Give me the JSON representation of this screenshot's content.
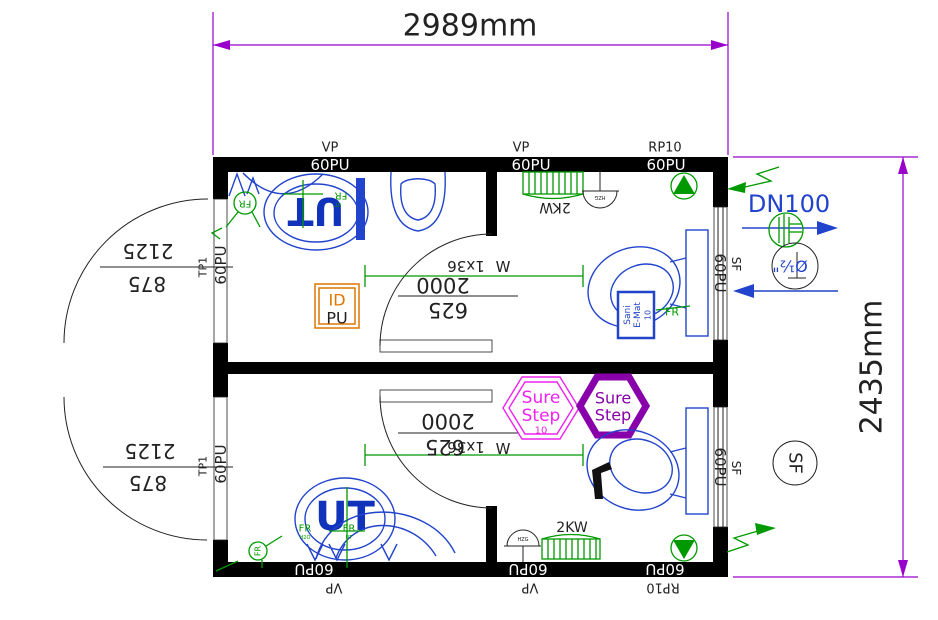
{
  "colors": {
    "wall": "#000000",
    "dimension": "#9900cc",
    "fixture_blue": "#2244cc",
    "logo_blue": "#1133bb",
    "annotation_green": "#009900",
    "hex_magenta": "#ee22ee",
    "hex_purple": "#8800aa",
    "id_orange": "#dd7700",
    "ink": "#222222"
  },
  "dimensions": {
    "overall_width": "2989mm",
    "overall_height": "2435mm",
    "door_height": "2125",
    "door_width": "875",
    "room_length": "2000",
    "room_offset": "625"
  },
  "walls": {
    "vp": "VP",
    "rp10": "RP10",
    "panel": "60PU",
    "door_panel": "TP1",
    "sf": "SF"
  },
  "annotations": {
    "dn100": "DN100",
    "pipe_diameter": "Ø½\"",
    "lamp": "1x36",
    "watt": "W",
    "heater": "2KW",
    "hzg": "HZG",
    "h2o": "H2O",
    "sf": "SF"
  },
  "brands": {
    "ut": "UT",
    "fr": "FR",
    "id_top": "ID",
    "id_bottom": "PU",
    "sure": "Sure",
    "step": "Step",
    "sure_step_no": "10",
    "sani_1": "Sani",
    "sani_2": "E-Mat",
    "sani_3": "10"
  }
}
